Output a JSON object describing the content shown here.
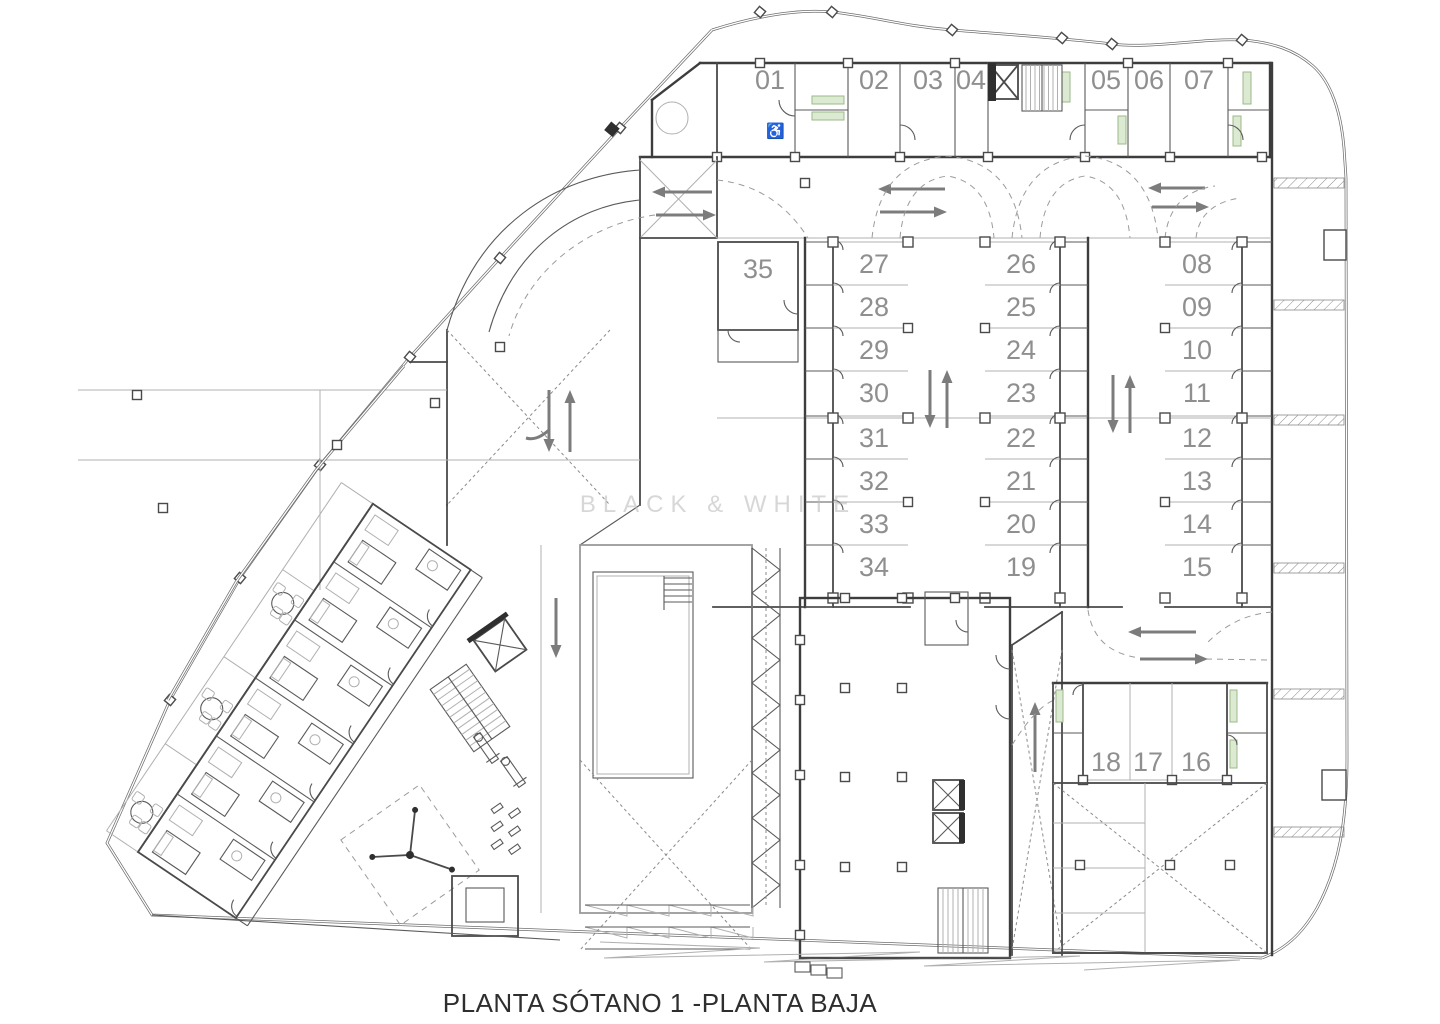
{
  "title": "PLANTA SÓTANO 1 -PLANTA  BAJA",
  "watermark": "BLACK & WHITE",
  "symbols": {
    "accessible_parking": "♿"
  },
  "colors": {
    "wall": "#3d3d3d",
    "light_line": "#b0b0b0",
    "label_gray": "#8f8f8f",
    "arrow_gray": "#7c7c7c",
    "storage_green": "#dcead2",
    "title_color": "#2e2e2e"
  },
  "parking": {
    "top_row": [
      "01",
      "02",
      "03",
      "04",
      "05",
      "06",
      "07"
    ],
    "column_a": [
      "27",
      "28",
      "29",
      "30",
      "31",
      "32",
      "33",
      "34"
    ],
    "column_b": [
      "26",
      "25",
      "24",
      "23",
      "22",
      "21",
      "20",
      "19"
    ],
    "column_c": [
      "08",
      "09",
      "10",
      "11",
      "12",
      "13",
      "14",
      "15"
    ],
    "bottom_row": [
      "18",
      "17",
      "16"
    ],
    "storage_room": "35"
  }
}
